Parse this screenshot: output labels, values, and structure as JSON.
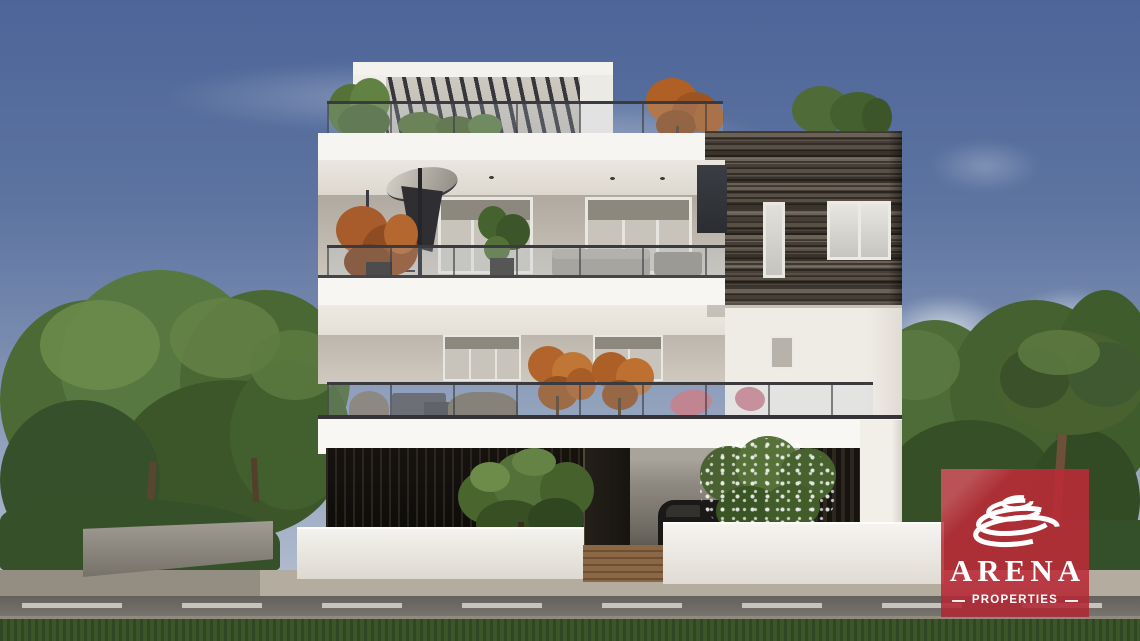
{
  "image_type": "3d-architectural-exterior-render",
  "scene": {
    "subject": "modern three-storey white apartment building with glass balconies, rooftop pergola, dark wood cladding, carport and street frontage, flanked by green trees under a blue sky"
  },
  "logo": {
    "brand": "ARENA",
    "tagline": "PROPERTIES",
    "icon": "arena-rings-icon",
    "brand_color": "#BE2A37"
  },
  "palette": {
    "sky_top": "#4D6598",
    "sky_horizon": "#B3BDD0",
    "foliage_green": "#4D6A35",
    "autumn_orange": "#B2652E",
    "building_white": "#F5F3EF",
    "wood_cladding": "#574F45",
    "road_asphalt": "#6E6A66",
    "grass": "#3C5629"
  }
}
